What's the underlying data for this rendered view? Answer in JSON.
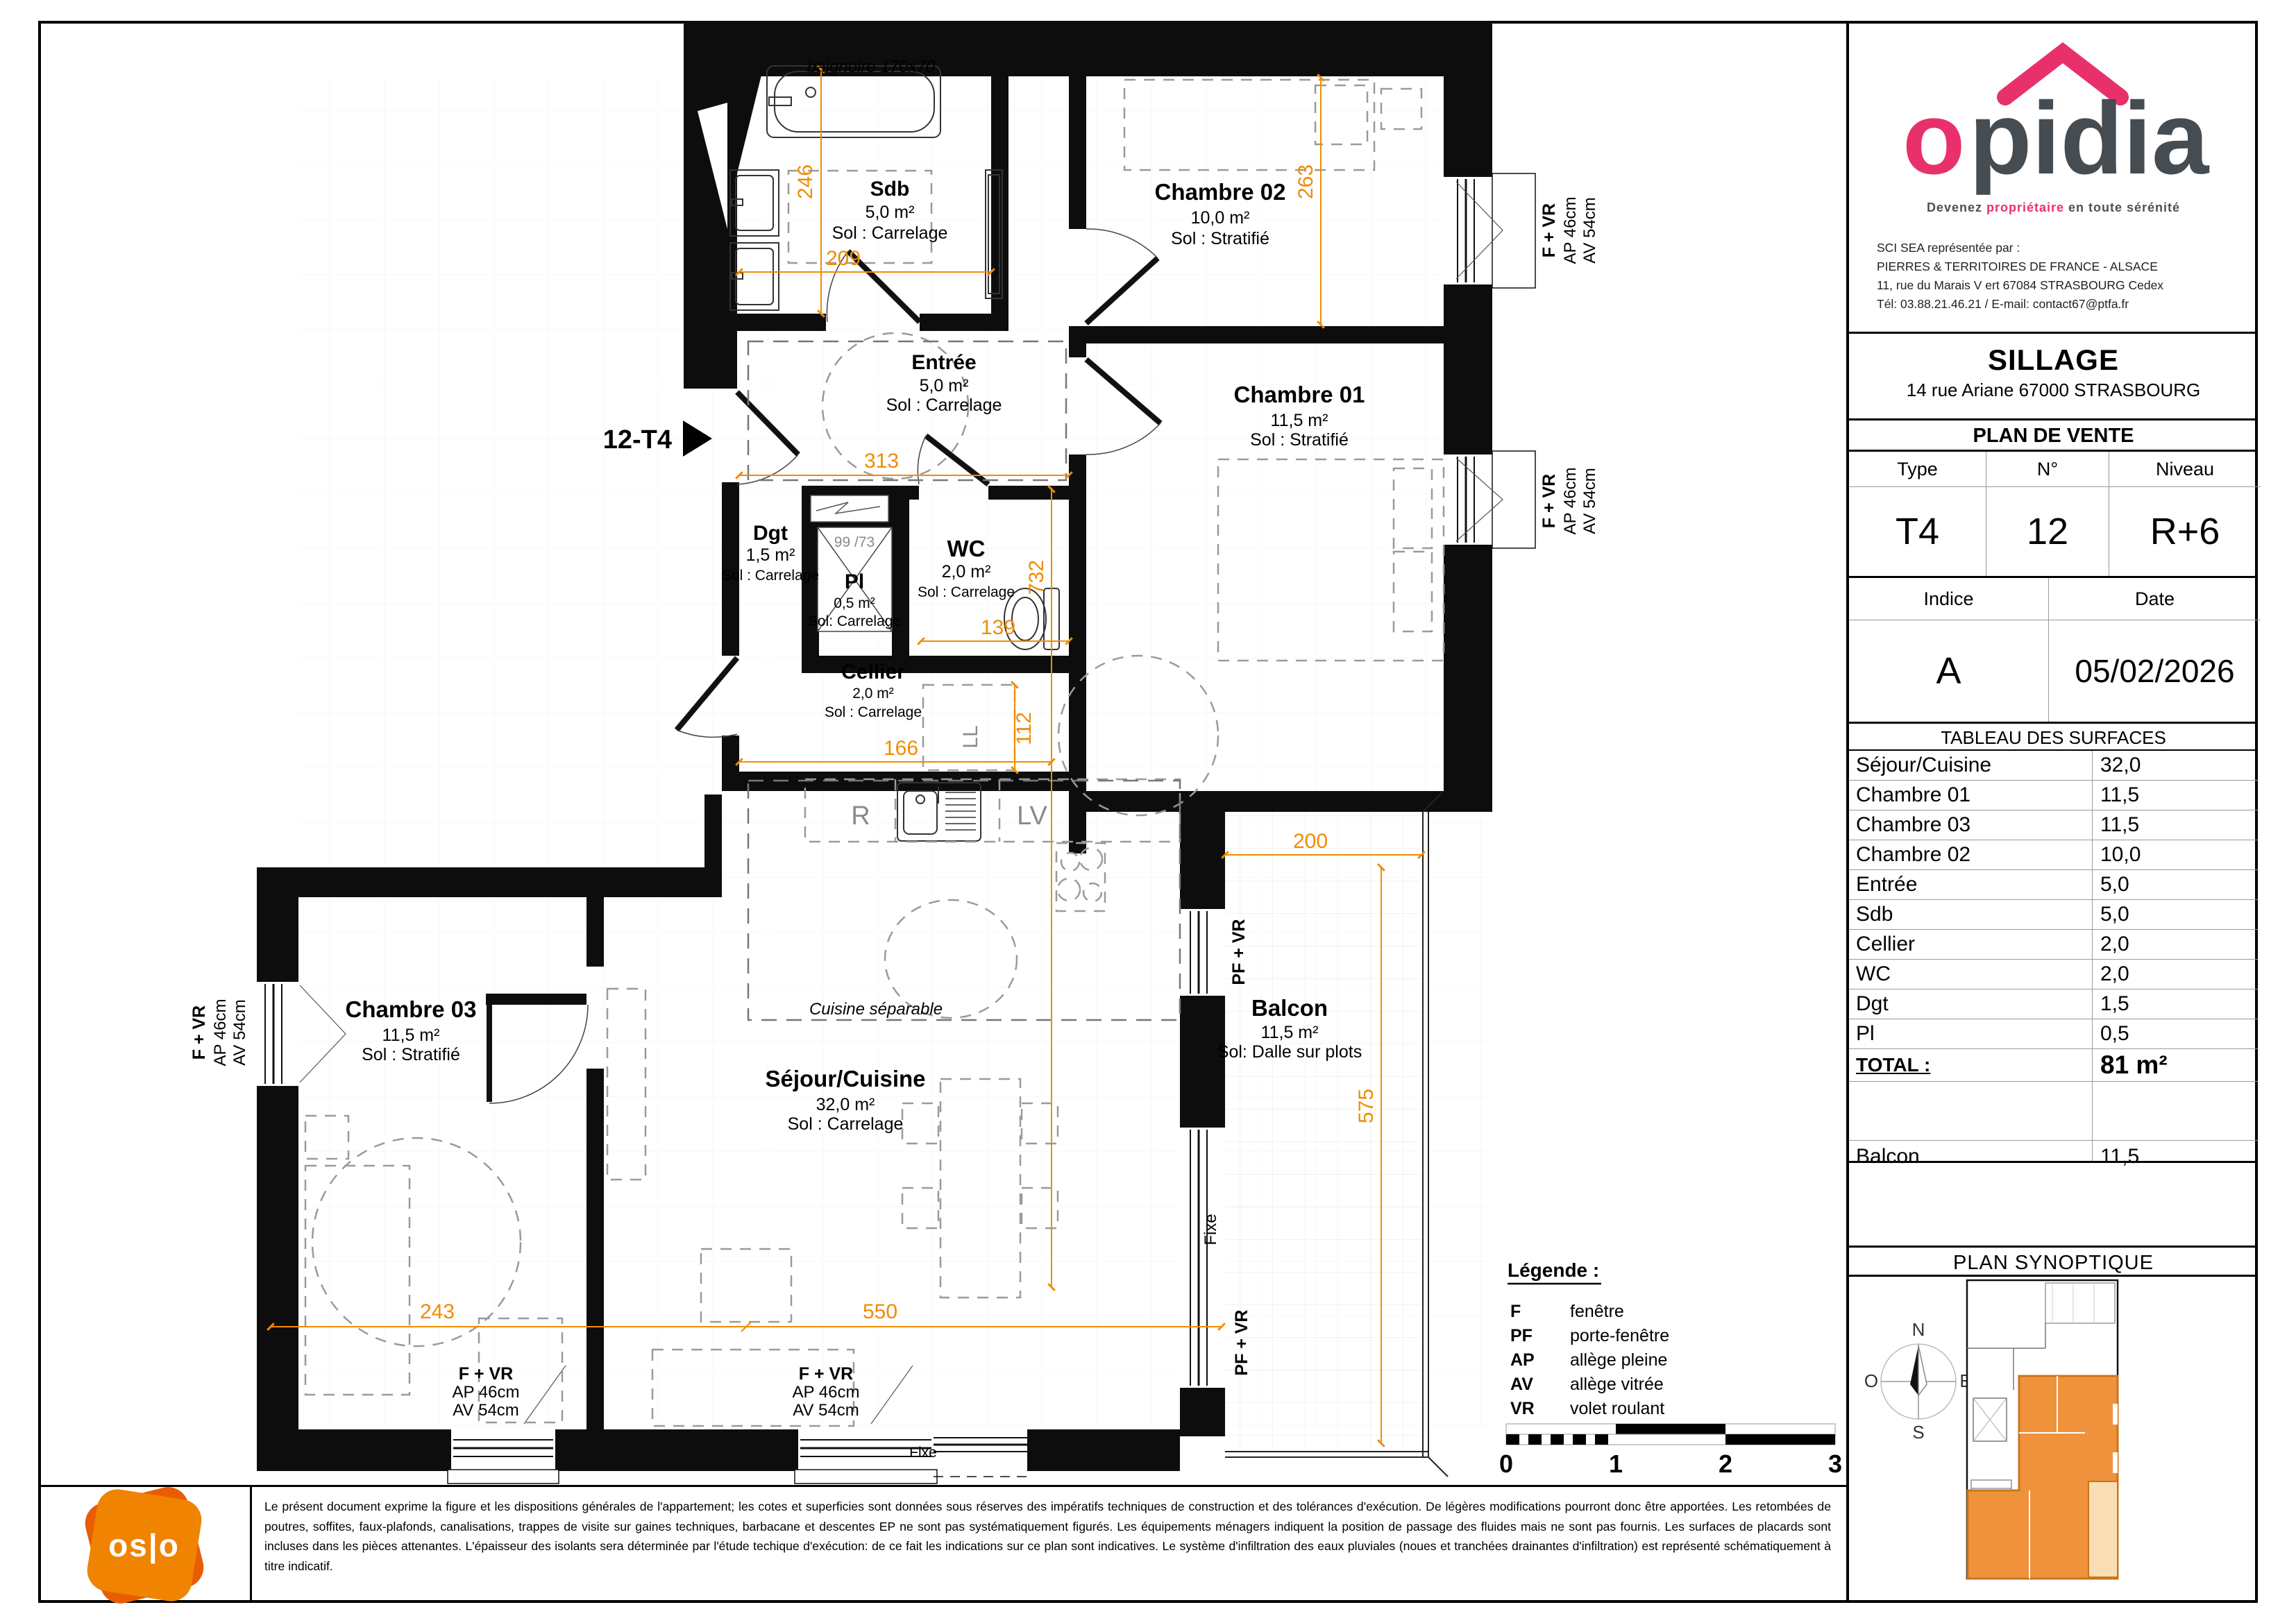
{
  "branding": {
    "logo": "opidia",
    "tagline": {
      "pre": "Devenez ",
      "accent": "propriétaire",
      "post": " en toute sérénité"
    },
    "contact": [
      "SCI SEA représentée par :",
      "PIERRES & TERRITOIRES DE FRANCE - ALSACE",
      "11, rue du Marais V ert 67084 STRASBOURG Cedex",
      "Tél: 03.88.21.46.21 / E-mail: contact67@ptfa.fr"
    ]
  },
  "project": {
    "name": "SILLAGE",
    "address": "14 rue Ariane 67000 STRASBOURG",
    "doc_title": "PLAN DE VENTE"
  },
  "unit": {
    "type_label": "Type",
    "type_value": "T4",
    "num_label": "N°",
    "num_value": "12",
    "level_label": "Niveau",
    "level_value": "R+6",
    "index_label": "Indice",
    "index_value": "A",
    "date_label": "Date",
    "date_value": "05/02/2026"
  },
  "surfaces": {
    "title": "TABLEAU DES SURFACES",
    "rows": [
      {
        "name": "Séjour/Cuisine",
        "value": "32,0"
      },
      {
        "name": "Chambre 01",
        "value": "11,5"
      },
      {
        "name": "Chambre 03",
        "value": "11,5"
      },
      {
        "name": "Chambre 02",
        "value": "10,0"
      },
      {
        "name": "Entrée",
        "value": "5,0"
      },
      {
        "name": "Sdb",
        "value": "5,0"
      },
      {
        "name": "Cellier",
        "value": "2,0"
      },
      {
        "name": "WC",
        "value": "2,0"
      },
      {
        "name": "Dgt",
        "value": "1,5"
      },
      {
        "name": "Pl",
        "value": "0,5"
      }
    ],
    "total_label": "TOTAL :",
    "total_value": "81 m²",
    "balcon_label": "Balcon",
    "balcon_value": "11,5"
  },
  "plan": {
    "marker": "12-T4",
    "rooms": {
      "sdb": {
        "name": "Sdb",
        "area": "5,0 m²",
        "floor": "Sol : Carrelage"
      },
      "ch02": {
        "name": "Chambre 02",
        "area": "10,0 m²",
        "floor": "Sol : Stratifié"
      },
      "ch01": {
        "name": "Chambre 01",
        "area": "11,5 m²",
        "floor": "Sol : Stratifié"
      },
      "entree": {
        "name": "Entrée",
        "area": "5,0 m²",
        "floor": "Sol : Carrelage"
      },
      "dgt": {
        "name": "Dgt",
        "area": "1,5 m²",
        "floor": "Sol : Carrelage"
      },
      "pl": {
        "name": "Pl",
        "area": "0,5 m²",
        "floor": "Sol: Carrelage"
      },
      "wc": {
        "name": "WC",
        "area": "2,0 m²",
        "floor": "Sol : Carrelage"
      },
      "cellier": {
        "name": "Cellier",
        "area": "2,0 m²",
        "floor": "Sol : Carrelage"
      },
      "ch03": {
        "name": "Chambre 03",
        "area": "11,5 m²",
        "floor": "Sol : Stratifié"
      },
      "sejour": {
        "name": "Séjour/Cuisine",
        "area": "32,0 m²",
        "floor": "Sol : Carrelage"
      },
      "balcon": {
        "name": "Balcon",
        "area": "11,5 m²",
        "floor": "Sol: Dalle sur plots"
      }
    },
    "dims": {
      "sdb_h": "246",
      "sdb_w": "209",
      "ch02_h": "263",
      "entree_w": "313",
      "col_h": "732",
      "wc_w": "139",
      "cellier_w": "166",
      "ll_w": "112",
      "ch03_w": "243",
      "sejour_w": "550",
      "balcon_w": "200",
      "balcon_h": "575"
    },
    "win": {
      "f": "F + VR",
      "ap": "AP 46cm",
      "av": "AV 54cm",
      "pf": "PF + VR",
      "fixe": "Fixe"
    },
    "ann": {
      "bath": "baignoire 170x70",
      "closet": "99 /73",
      "cuisine": "Cuisine séparable",
      "ll": "LL",
      "fridge": "R",
      "dishwasher": "LV"
    }
  },
  "legend": {
    "title": "Légende :",
    "items": [
      {
        "abbr": "F",
        "label": "fenêtre"
      },
      {
        "abbr": "PF",
        "label": "porte-fenêtre"
      },
      {
        "abbr": "AP",
        "label": "allège pleine"
      },
      {
        "abbr": "AV",
        "label": "allège vitrée"
      },
      {
        "abbr": "VR",
        "label": "volet roulant"
      }
    ]
  },
  "scalebar": {
    "ticks": [
      "0",
      "1",
      "2",
      "3"
    ]
  },
  "synoptique": {
    "title": "PLAN SYNOPTIQUE",
    "compass": {
      "n": "N",
      "s": "S",
      "e": "E",
      "o": "O"
    }
  },
  "colors": {
    "dim_orange": "#f08c00",
    "brand_pink": "#e8316b",
    "synoptic_orange": "#f0913c",
    "synoptic_balcony": "#f9ddb5"
  },
  "footer": {
    "disclaimer": "Le présent document exprime la figure et les dispositions générales de l'appartement; les cotes et superficies sont données sous réserves des impératifs techniques de construction et des tolérances d'exécution. De légères modifications pourront donc être apportées. Les retombées de poutres, soffites, faux-plafonds, canalisations, trappes de visite sur gaines techniques, barbacane et descentes EP ne sont pas systématiquement figurés. Les équipements ménagers indiquent la position de passage des fluides mais ne sont pas fournis. Les surfaces de placards sont incluses dans les pièces attenantes. L'épaisseur des isolants sera déterminée par l'étude techique d'exécution: de ce fait les indications sur ce plan sont indicatives. Le système d'infiltration des eaux pluviales (noues et tranchées drainantes d'infiltration) est représenté schématiquement à titre indicatif.",
    "oslo": "os|o"
  }
}
